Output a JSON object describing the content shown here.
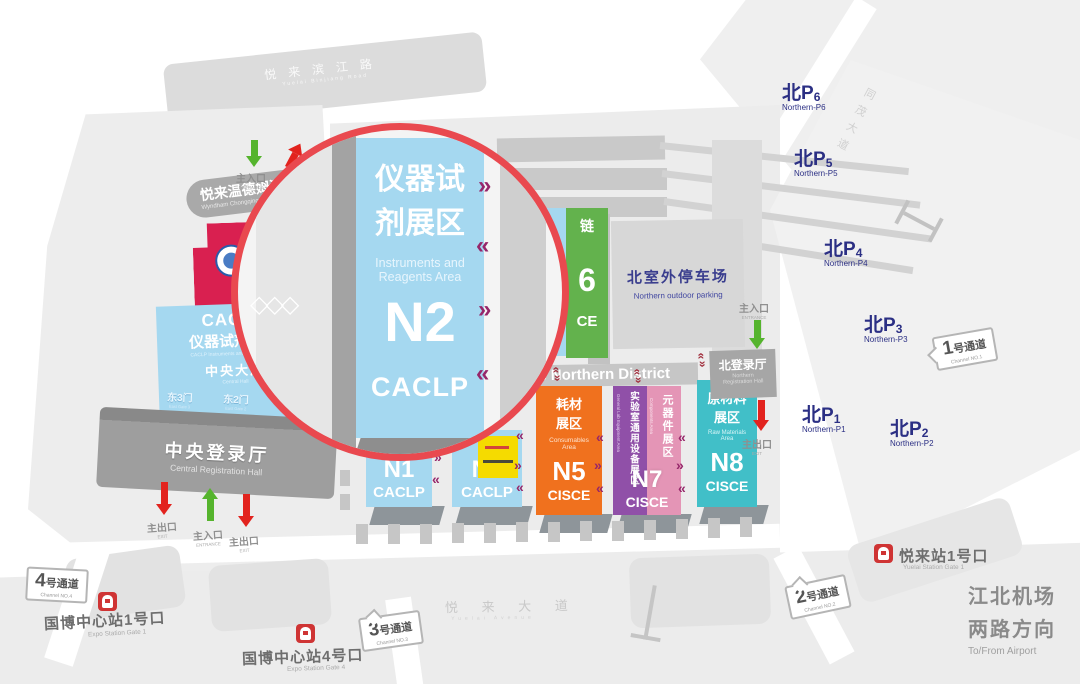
{
  "streets": {
    "binjiang": {
      "zh": "悦来滨江路",
      "en": "Yuelai Binjiang Road"
    },
    "tongmao": {
      "zh": "同茂大道"
    },
    "yuelai_ave": {
      "zh": "悦 来 大 道",
      "en": "Yuelai Avenue"
    }
  },
  "magnifier": {
    "zh1": "仪器试",
    "zh2": "剂展区",
    "en1": "Instruments and",
    "en2": "Reagents Area",
    "id": "N2",
    "expo": "CACLP"
  },
  "left": {
    "hotel": {
      "zh": "悦来温德姆酒店",
      "en": "Wyndham Chongqing Yuelai"
    },
    "conference": {
      "zh": "悦来会议中心",
      "en1": "ChongQing Yuelai",
      "en2": "Conference Center"
    },
    "central_hall": {
      "expo": "CACLP",
      "area_zh": "仪器试剂展区",
      "area_en": "CACLP Instruments and Reagents Area",
      "hall_zh": "中央大厅",
      "hall_en": "Central Hall",
      "gates": [
        {
          "zh": "东3门",
          "en": "East Gate 3"
        },
        {
          "zh": "东2门",
          "en": "East Gate 2"
        },
        {
          "zh": "东1门",
          "en": "East Gate 1"
        }
      ]
    },
    "registration": {
      "zh": "中央登录厅",
      "en": "Central Registration Hall"
    }
  },
  "labels": {
    "entrance_zh": "主入口",
    "entrance_en": "ENTRANCE",
    "exit_zh": "主出口",
    "exit_en": "EXIT"
  },
  "north": {
    "outdoor_parking": {
      "zh": "北室外停车场",
      "en": "Northern outdoor parking"
    },
    "registration": {
      "zh": "北登录厅",
      "en1": "Northern",
      "en2": "Registration Hall"
    },
    "district_banner": "The Northern District"
  },
  "halls": {
    "n1": {
      "id": "N1",
      "expo": "CACLP"
    },
    "n3": {
      "id": "N3",
      "expo": "CACLP"
    },
    "n5": {
      "id": "N5",
      "expo": "CISCE",
      "zh1": "耗材",
      "zh2": "展区",
      "en1": "Consumables",
      "en2": "Area"
    },
    "n7": {
      "id": "N7",
      "expo": "CISCE",
      "left_zh": "实验室通用设备展区",
      "left_en": "General Lab Equipment Area",
      "right_zh": "元器件展区",
      "right_en": "Components Area"
    },
    "n8": {
      "id": "N8",
      "expo": "CISCE",
      "zh1": "原材料",
      "zh2": "展区",
      "en1": "Raw Materials",
      "en2": "Area"
    },
    "n6": {
      "frag_zh": "链",
      "frag_digit": "6",
      "frag_expo": "CE"
    },
    "n4": {
      "frag1": "Inst",
      "frag2": "Re"
    }
  },
  "parkings": [
    {
      "id": "北P",
      "num": "6",
      "en": "Northern-P6"
    },
    {
      "id": "北P",
      "num": "5",
      "en": "Northern-P5"
    },
    {
      "id": "北P",
      "num": "4",
      "en": "Northern-P4"
    },
    {
      "id": "北P",
      "num": "3",
      "en": "Northern-P3"
    },
    {
      "id": "北P",
      "num": "1",
      "en": "Northern-P1"
    },
    {
      "id": "北P",
      "num": "2",
      "en": "Northern-P2"
    }
  ],
  "channels": [
    {
      "num": "4",
      "label": "号通道",
      "en": "Channel NO.4"
    },
    {
      "num": "1",
      "label": "号通道",
      "en": "Channel NO.1"
    },
    {
      "num": "2",
      "label": "号通道",
      "en": "Channel NO.2"
    },
    {
      "num": "3",
      "label": "号通道",
      "en": "Channel NO.3"
    }
  ],
  "stations": {
    "expo1": {
      "zh": "国博中心站1号口",
      "en": "Expo Station Gate 1"
    },
    "expo4": {
      "zh": "国博中心站4号口",
      "en": "Expo Station Gate 4"
    },
    "yuelai1": {
      "zh": "悦来站1号口",
      "en": "Yuelai Station Gate 1"
    }
  },
  "airport": {
    "zh1": "江北机场",
    "zh2": "两路方向",
    "en": "To/From Airport"
  },
  "glyphs": {
    "chevron_left": "«",
    "chevron_right": "»",
    "diamonds": "◇◇◇"
  },
  "colors": {
    "caclp_blue": "#A5D8F0",
    "cisce_orange": "#F0711E",
    "cisce_purple": "#9050A8",
    "cisce_pink": "#E495B6",
    "cisce_teal": "#41BFC8",
    "conference_red": "#D92050",
    "ring_red": "#E9494F",
    "chevron_purple": "#96266A",
    "navy": "#2B2F84"
  }
}
